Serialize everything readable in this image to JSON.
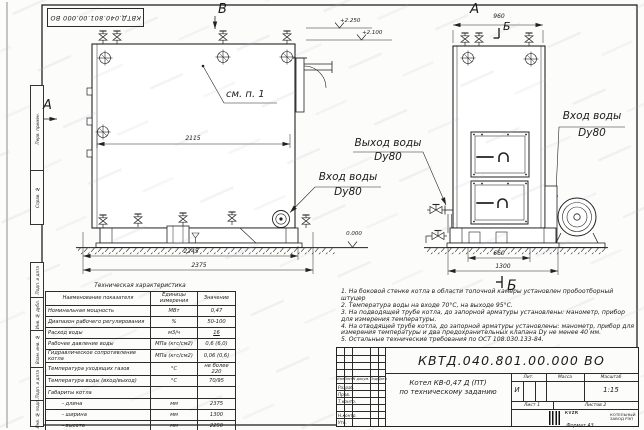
{
  "stamp": "КВТД.040.801.00.000 ВО",
  "margin_labels": [
    "Перв. примен.",
    "Справ. №",
    "Подп. и дата",
    "Инв. № дубл.",
    "Взам. инв. №",
    "Подп. и дата",
    "Инв. № подл."
  ],
  "format_label": "Формат А3",
  "drawing": {
    "view_letter_left": "А",
    "view_letter_top": "В",
    "front_view_title": "А",
    "section_top": "Б",
    "section_bottom": "Б",
    "callout_see_item": "см. п. 1",
    "dims": {
      "inner_length": "2115",
      "base_length": "2245",
      "overall_length": "2375",
      "front_width": "960",
      "base_width": "660",
      "overall_width": "1300"
    },
    "elevations": {
      "top": "+2.250",
      "mid": "+2.100",
      "zero": "0.000"
    },
    "labels": {
      "inlet_side_1": "Вход воды",
      "inlet_side_2": "Dy80",
      "outlet_1": "Выход воды",
      "outlet_2": "Dy80",
      "inlet_front_1": "Вход воды",
      "inlet_front_2": "Dy80"
    }
  },
  "notes": [
    "1. На боковой стенке котла в области топочной камеры установлен пробоотборный штуцер",
    "2. Температура воды на входе 70°С, на выходе 95°С.",
    "3. На подводящей трубе котла, до запорной арматуры установлены: манометр, прибор для измерения температуры.",
    "4. На отводящей трубе котла, до запорной арматуры установлены: манометр, прибор для измерения температуры и два предохранительных клапана Dy не менее 40 мм.",
    "5. Остальные технические требования по ОСТ 108.030.133-84."
  ],
  "table": {
    "title": "Техническая характеристика",
    "col_name": "Наименование показателя",
    "col_units": "Единицы измерения",
    "col_value": "Значение",
    "rows": [
      {
        "n": "Номинальная мощность",
        "u": "МВт",
        "v": "0,47"
      },
      {
        "n": "Диапазон рабочего регулирования",
        "u": "%",
        "v": "50-100"
      },
      {
        "n": "Расход воды",
        "u": "м3/ч",
        "v": "16"
      },
      {
        "n": "Рабочее давление воды",
        "u": "МПа (кгс/см2)",
        "v": "0,6 (6,0)"
      },
      {
        "n": "Гидравлическое сопротивление котла",
        "u": "МПа (кгс/см2)",
        "v": "0,06 (0,6)"
      },
      {
        "n": "Температура уходящих газов",
        "u": "°С",
        "v": "не более 220"
      },
      {
        "n": "Температура воды (вход/выход)",
        "u": "°С",
        "v": "70/95"
      },
      {
        "n": "Габариты котла",
        "u": "",
        "v": ""
      },
      {
        "n": "- длина",
        "u": "мм",
        "v": "2375"
      },
      {
        "n": "- ширина",
        "u": "мм",
        "v": "1300"
      },
      {
        "n": "- высота",
        "u": "мм",
        "v": "2250"
      }
    ]
  },
  "title_block": {
    "designation": "КВТД.040.801.00.000 ВО",
    "title_1": "Котел КВ-0,47 Д (ПТ)",
    "title_2": "по техническому заданию",
    "col_izm": "Изм",
    "col_list": "Лист",
    "col_doc": "N докум.",
    "col_podp": "Подп.",
    "col_data": "Дата",
    "row_1": "Разраб.",
    "row_2": "Пров.",
    "row_3": "Т.контр.",
    "row_4": "Н.контр.",
    "row_5": "Утв.",
    "lit_label": "Лит.",
    "mass_label": "Масса",
    "scale_label": "Масштаб",
    "lit_value": "И",
    "scale_value": "1:15",
    "sheet_label": "Лист",
    "sheet_num": "1",
    "sheets_label": "Листов",
    "sheets_num": "2",
    "logo": "KVZR",
    "company_1": "КОТЕЛЬНЫЙ",
    "company_2": "ЗАВОД РЭП"
  }
}
